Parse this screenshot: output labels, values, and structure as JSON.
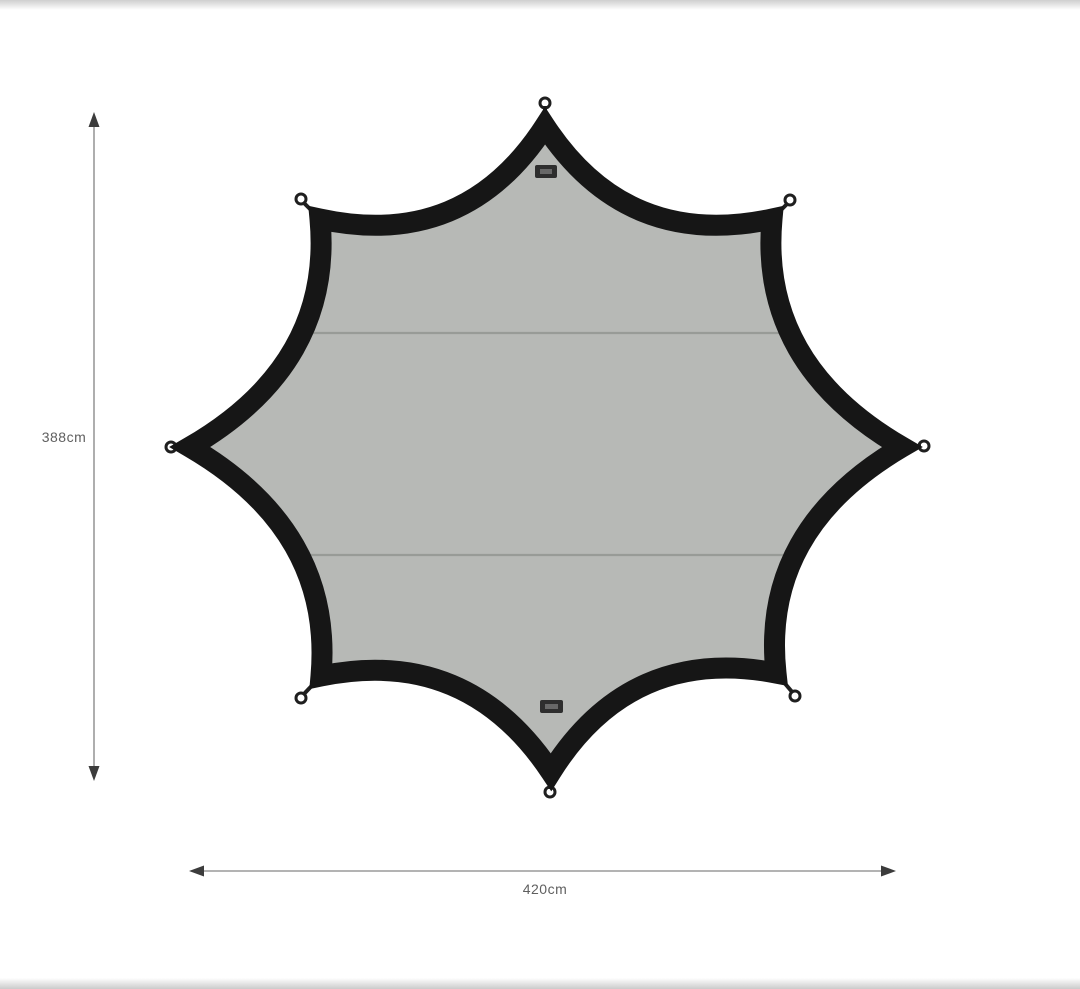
{
  "page": {
    "background": "#ffffff",
    "description": "Product dimension diagram of an eight-point star camping tarp, top view"
  },
  "colors": {
    "page-bg": "#ffffff",
    "fabric": "#b7b9b6",
    "border": "#161616",
    "seam": "#989b97",
    "loop": "#1f1f1f",
    "tag": "#2e2e2e",
    "dim-line": "#9a9a9a",
    "dim-arrow": "#3c3c3c",
    "dim-text": "#5f5f5f",
    "photo-edge": "#c2c2c2"
  },
  "diagram": {
    "subject": "octagonal star tarp",
    "point_count": 8,
    "seam_count": 2,
    "height_label": "388cm",
    "width_label": "420cm"
  }
}
